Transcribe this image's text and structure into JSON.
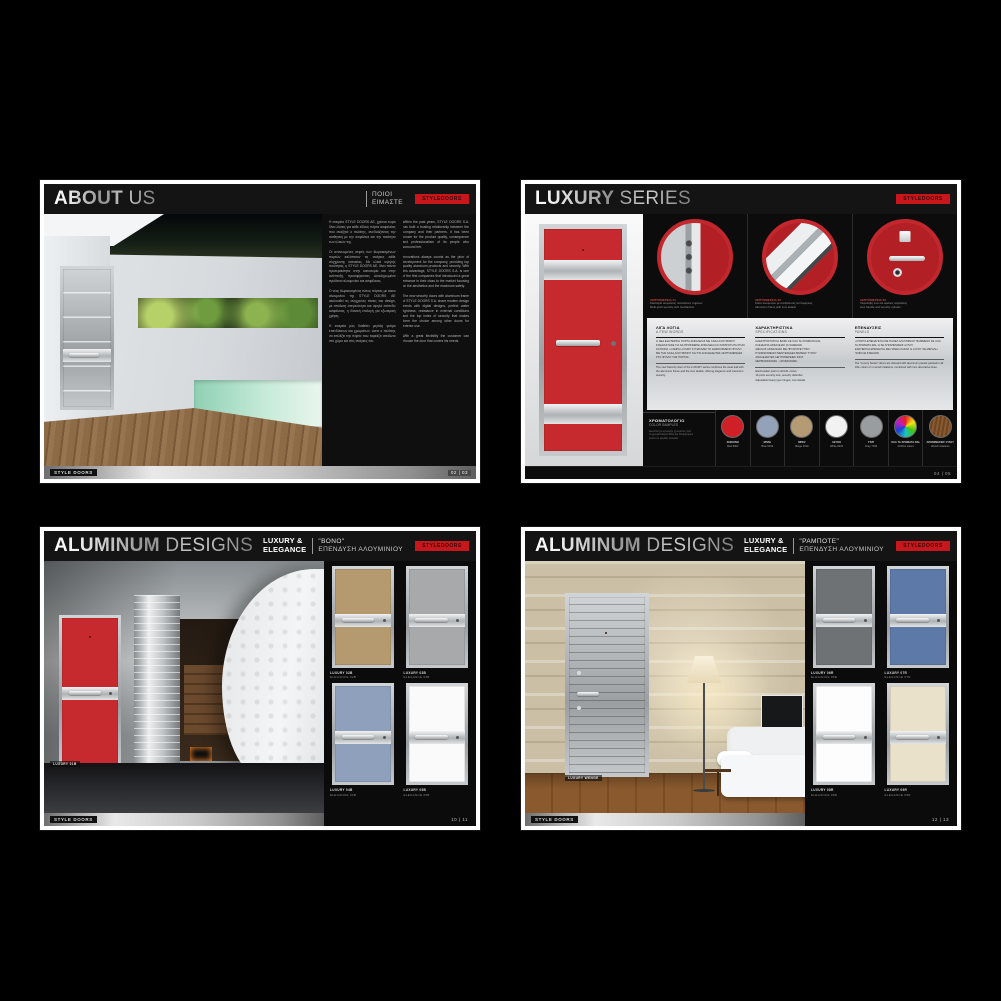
{
  "canvas": {
    "bg": "#000000"
  },
  "brand": {
    "logo_text": "STYLEDOORS",
    "footer_brand": "STYLE DOORS"
  },
  "about": {
    "title_strong": "ABOUT",
    "title_light": "US",
    "subtitle_line1": "ΠΟΙΟΙ",
    "subtitle_line2": "ΕΙΜΑΣΤΕ",
    "page_number": "02 | 03",
    "col1": [
      "Η εταιρεία STYLE DOORS ΑΕ, χρόνια τώρα δίνει λύσεις για κάθε είδους πόρτα ασφαλείας που αναζητά ο πελάτης, συνδυάζοντας την αισθητική με την ασφάλεια και την ποιότητα των υλικών της.",
      "",
      "Οι ανανεωμένες σειρές των θωρακισμένων πορτών καλύπτουν τις ανάγκες κάθε σύγχρονης κατοικίας. Με υλικά υψηλής ποιότητας, η STYLE DOORS ΑΕ, δίνει πάντα προτεραιότητα στην καινοτομία και στην ανάπτυξη, προσφέροντας ολοκληρωμένα προϊόντα αλουμινίου και ασφάλειας.",
      "",
      "Ο νέος θωρακισμένος τύπος πόρτας με κάσα αλουμινίου της STYLE DOORS ΑΕ ακολουθεί τις σύγχρονες τάσεις του design, με απόλυτη στεγανότητα και υψηλό επίπεδο ασφάλειας, η ιδανική επιλογή για εξωτερική χρήση.",
      "",
      "Η εταιρεία μας διαθέτει μεγάλη γκάμα επενδύσεων και χρωμάτων, ώστε ο πελάτης να επιλέξει την πόρτα που ταιριάζει απόλυτα στο χώρο και στις ανάγκες του."
    ],
    "col2": [
      "Within the past years, STYLE DOORS S.A. has built a trusting relationship between the company and their partners. It has been known for the product quality, consequence and professionalism of its people who surround her.",
      "",
      "Innovations always counts as the prior of development for the company, providing top quality aluminum products and security. With this advantage, STYLE DOORS S.A. is one of the first companies that introduced a great entrance in their class to the market focusing on the aesthetics and the maximum safety.",
      "",
      "The new security doors with aluminum frame of STYLE DOORS S.A. share modern design trends with digital designs, perfect water tightness, resistance in external conditions and the top index of security that makes them the choice among other doors for exterior use.",
      "",
      "With a great flexibility the customer can choose the door that covers his needs."
    ]
  },
  "luxury": {
    "title_strong": "LUXURY",
    "title_light": "SERIES",
    "page_number": "04 | 05",
    "circles": [
      {
        "tag": "ΛΕΠΤΟΜΕΡΕΙΑ 01",
        "l1": "Κλειδαριά ασφαλείας πολλαπλών σημείων",
        "l2": "Multi-point security lock mechanism"
      },
      {
        "tag": "ΛΕΠΤΟΜΕΡΕΙΑ 02",
        "l1": "Κάσα αλουμινίου με ανοξείδωτες λεπτομέρειες",
        "l2": "Aluminum frame with inox details"
      },
      {
        "tag": "ΛΕΠΤΟΜΕΡΕΙΑ 03",
        "l1": "Χειρολαβή inox και αφαλός ασφαλείας",
        "l2": "Inox handle and security cylinder"
      }
    ],
    "sections": [
      {
        "el": "ΛΙΓΑ ΛΟΓΙΑ",
        "en": "A FEW WORDS",
        "lines": [
          "Η ΝΕΑ ΕΞΩΤΕΡΙΚΗ ΠΟΡΤΑ ΑΣΦΑΛΕΙΑΣ ΜΕ ΚΑΣΑ ΑΛΟΥΜΙΝΙΟΥ ΣΧΕΔΙΑΣΤΗΚΕ ΓΙΑ ΝΑ ΠΡΟΣΦΕΡΕΙ ΑΣΦΑΛΕΙΑ ΚΑΙ ΚΟΜΨΟΤΗΤΑ ΣΤΗΝ ΚΑΤΟΙΚΙΑ. Η ΣΕΙΡΑ LUXURY ΣΥΝΔΥΑΖΕΙ ΤΟ ΘΩΡΑΚΙΣΜΕΝΟ ΦΥΛΛΟ ΜΕ ΤΗΝ ΚΑΣΑ ΑΛΟΥΜΙΝΙΟΥ ΚΑΙ ΤΙΣ ΑΝΟΞΕΙΔΩΤΕΣ ΛΕΠΤΟΜΕΡΕΙΕΣ ΣΤΟ ΦΥΛΛΟ ΤΗΣ ΠΟΡΤΑΣ."
        ],
        "notes": [
          "The new Security door of the LUXURY series combines the steel leaf with the aluminum frame and the inox details, offering elegance and maximum security."
        ]
      },
      {
        "el": "ΧΑΡΑΚΤΗΡΙΣΤΙΚΑ",
        "en": "SPECIFICATIONS",
        "lines": [
          "ΗΛΕΚΤΡΟΣΤΑΤΙΚΗ ΒΑΦΗ ΣΕ ΟΛΑ ΤΑ ΧΡΩΜΑΤΑ RAL",
          "ΚΛΕΙΔΑΡΙΑ ΑΣΦΑΛΕΙΑΣ 16 ΣΗΜΕΙΩΝ",
          "ΑΦΑΛΟΣ ΑΣΦΑΛΕΙΑΣ ΜΕ ΠΡΟΣΤΑΤΕΥΤΙΚΟ",
          "ΡΥΘΜΙΖΟΜΕΝΟΙ ΜΕΝΤΕΣΕΔΕΣ ΒΑΡΕΩΣ ΤΥΠΟΥ",
          "ΑΝΟΞΕΙΔΩΤΕΣ ΛΕΠΤΟΜΕΡΕΙΕΣ INOX",
          "ΘΕΡΜΟΜΟΝΩΣΗ - ΗΧΟΜΟΝΩΣΗ"
        ],
        "notes": [
          "Electrostatic paint in all RAL colors",
          "16-point security lock, security defender",
          "Adjustable heavy type hinges, inox details"
        ]
      },
      {
        "el": "ΕΠΕΝΔΥΣΕΙΣ",
        "en": "PANELS",
        "lines": [
          "Η ΠΟΡΤΑ ΕΠΕΝΔΥΕΤΑΙ ΜΕ ΠΑΝΕΛ ΑΛΟΥΜΙΝΙΟΥ ΒΑΜΜΕΝΟ ΣΕ ΟΛΑ ΤΑ ΧΡΩΜΑΤΑ RAL Ή ΣΕ ΑΠΟΜΙΜΗΣΕΙΣ ΞΥΛΟΥ.",
          "ΕΣΩΤΕΡΙΚΗ ΕΠΕΝΔΥΣΗ ΜΕ ΠΑΝΕΛ ΛΑΚΑΣ Ή ΞΥΛΟΥ ΣΕ ΜΕΓΑΛΗ ΠΟΙΚΙΛΙΑ ΣΧΕΔΙΩΝ."
        ],
        "notes": [
          "The \"Luxury Series\" doors are dressed with aluminum panels painted in all RAL colors or in wood imitations, combined with inox decorative lines."
        ]
      }
    ],
    "colors_label_el": "ΧΡΩΜΑΤΟΛΟΓΙΟ",
    "colors_label_en": "COLOR SAMPLES",
    "colors_note": [
      "Δυνατότητα επιλογής χρώματος από",
      "το χρωματολόγιο RAL και απομιμήσεις",
      "ξύλου σε μεγάλη ποικιλία."
    ],
    "swatches": [
      {
        "name1": "ΚΟΚΚΙΝΟ",
        "name2": "Red 3002",
        "color": "#d02027"
      },
      {
        "name1": "ΜΠΛΕ",
        "name2": "Blue 5014",
        "color": "#93a2b8"
      },
      {
        "name1": "ΜΠΕΖ",
        "name2": "Beige 1019",
        "color": "#b59a73"
      },
      {
        "name1": "ΛΕΥΚΟ",
        "name2": "White 9016",
        "color": "#f2f2f2"
      },
      {
        "name1": "ΓΚΡΙ",
        "name2": "Grey 7040",
        "color": "#9a9da0"
      },
      {
        "name1": "ΟΛΑ ΤΑ ΧΡΩΜΑΤΑ RAL",
        "name2": "All RAL colors",
        "color": "rainbow"
      },
      {
        "name1": "ΑΠΟΜΙΜΗΣΕΙΣ ΞΥΛΟΥ",
        "name2": "Wood imitations",
        "color": "wood"
      }
    ]
  },
  "aluminum": {
    "title_strong": "ALUMINUM",
    "title_light": "DESIGNS",
    "badge1": "LUXURY &",
    "badge2": "ELEGANCE"
  },
  "bono": {
    "sub1": "\"ΒΟΝΟ\"",
    "sub2": "ΕΠΕΝΔΥΣΗ ΑΛΟΥΜΙΝΙΟΥ",
    "photo_caption": "LUXURY 01B",
    "page_number": "10 | 11",
    "thumbs": [
      {
        "l1": "LUXURY 02B",
        "l2": "ELEGANCE 02B",
        "color": "#b59a70"
      },
      {
        "l1": "LUXURY 03B",
        "l2": "ELEGANCE 03B",
        "color": "#a7a9ab"
      },
      {
        "l1": "LUXURY 04B",
        "l2": "ELEGANCE 04B",
        "color": "#8fa0bd"
      },
      {
        "l1": "LUXURY 05B",
        "l2": "ELEGANCE 05B",
        "color": "#fafafa"
      }
    ]
  },
  "rabote": {
    "sub1": "\"ΡΑΜΠΟΤΕ\"",
    "sub2": "ΕΠΕΝΔΥΣΗ ΑΛΟΥΜΙΝΙΟΥ",
    "photo_caption": "LUXURY WENGE",
    "page_number": "12 | 13",
    "thumbs": [
      {
        "l1": "LUXURY 06R",
        "l2": "ELEGANCE 06R",
        "color": "#6f7274"
      },
      {
        "l1": "LUXURY 07R",
        "l2": "ELEGANCE 07R",
        "color": "#5d79a8"
      },
      {
        "l1": "LUXURY 08R",
        "l2": "ELEGANCE 08R",
        "color": "#fdfdfd"
      },
      {
        "l1": "LUXURY 09R",
        "l2": "ELEGANCE 09R",
        "color": "#eae1cb"
      }
    ]
  }
}
